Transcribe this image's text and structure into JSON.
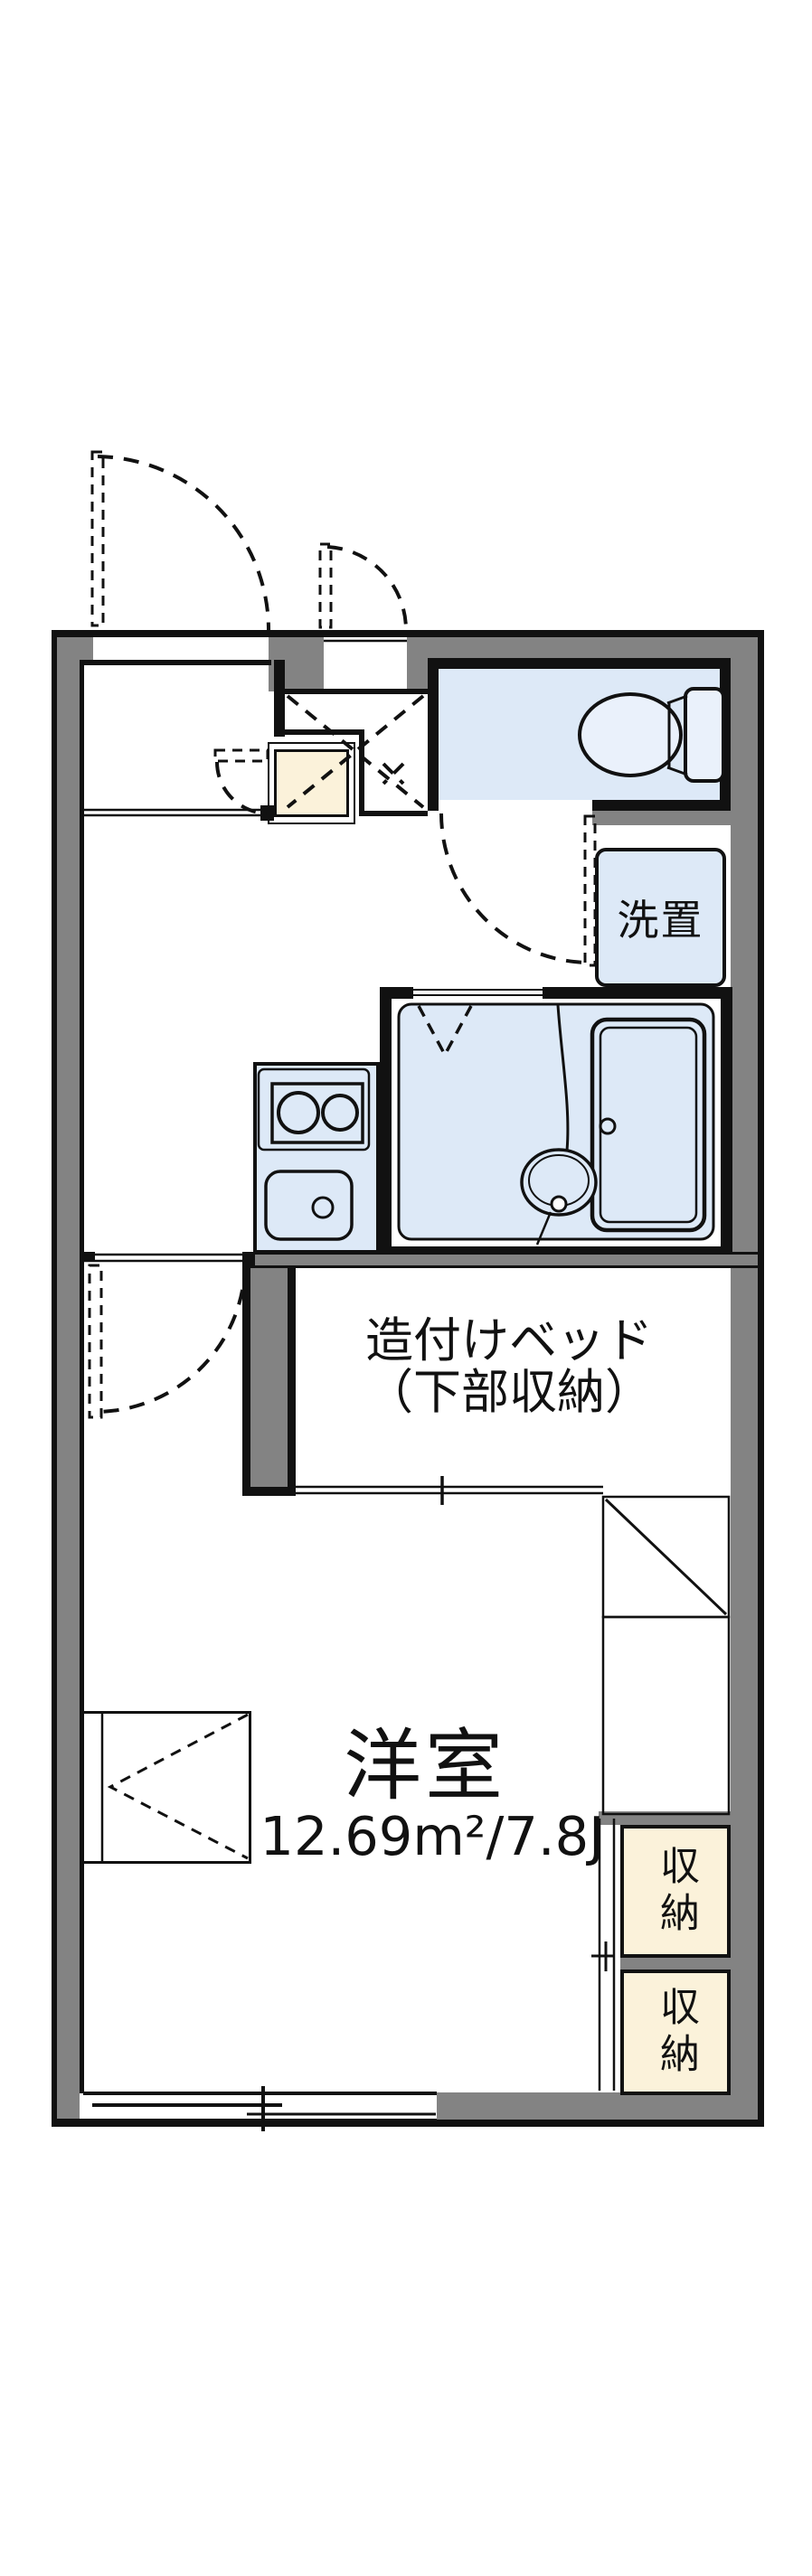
{
  "floorplan": {
    "labels": {
      "washer_place": "洗置",
      "built_in_bed_line1": "造付けベッド",
      "built_in_bed_line2": "（下部収納）",
      "main_room_name": "洋室",
      "main_room_area": "12.69m²/7.8J",
      "storage_upper": "収納",
      "storage_lower": "収納"
    },
    "colors": {
      "wall_gray": "#838383",
      "outline_black": "#111111",
      "wet_area_blue": "#dde9f7",
      "storage_cream": "#fbf2da",
      "background": "#ffffff"
    }
  }
}
